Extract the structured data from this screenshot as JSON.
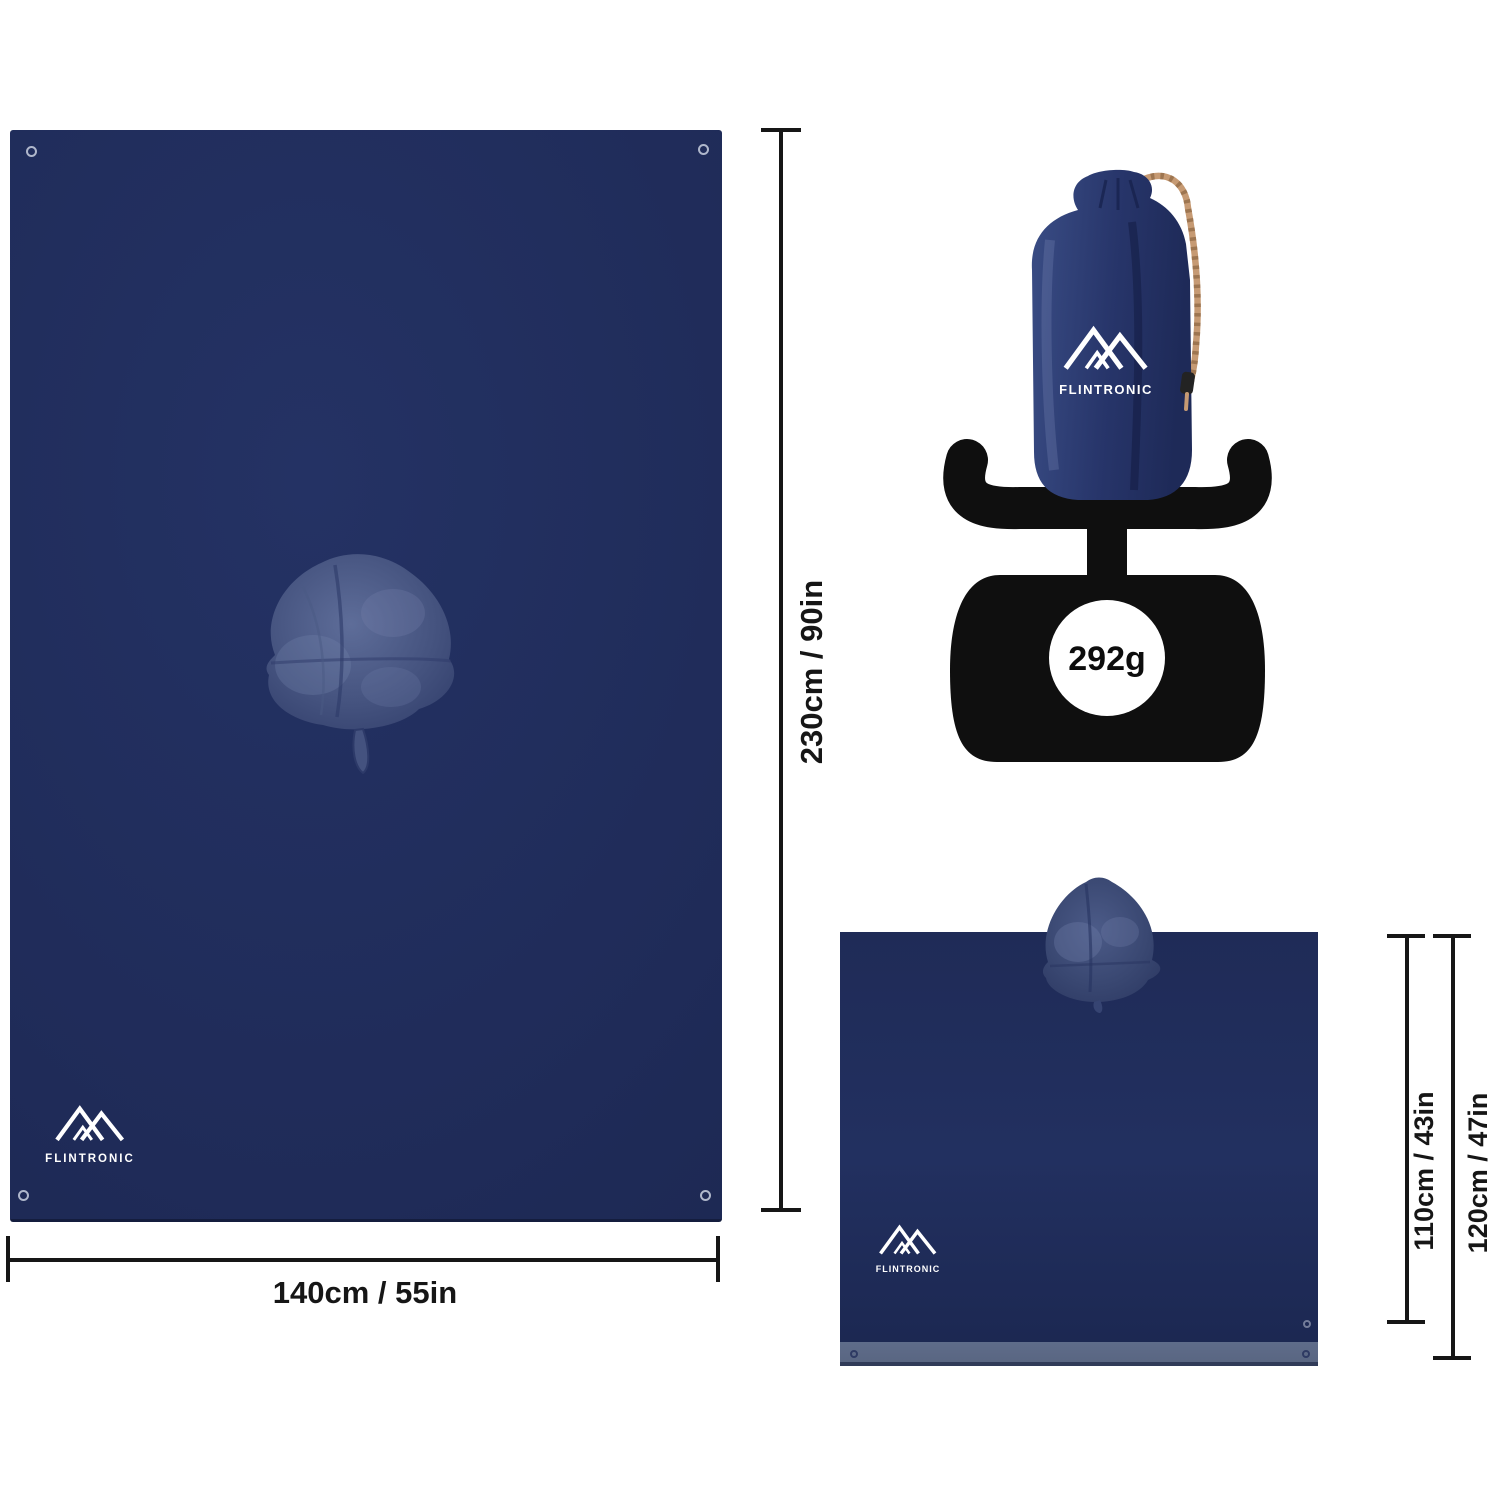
{
  "brand": {
    "name": "FLINTRONIC",
    "logo_icon": "mountain-peaks-icon"
  },
  "weight": {
    "value": "292g",
    "icon": "kitchen-scale-icon"
  },
  "dimensions": {
    "tarp_height": "230cm / 90in",
    "tarp_width": "140cm / 55in",
    "poncho_inner_height": "110cm / 43in",
    "poncho_outer_height": "120cm / 47in"
  },
  "colors": {
    "fabric_navy": "#202c5a",
    "hood_highlight": "#5e6d99",
    "trim_slate": "#5c6987",
    "cord_tan": "#c69a73",
    "scale_black": "#0f0f0f",
    "dimension_line": "#161616",
    "logo_white": "#ffffff",
    "background": "#ffffff"
  }
}
